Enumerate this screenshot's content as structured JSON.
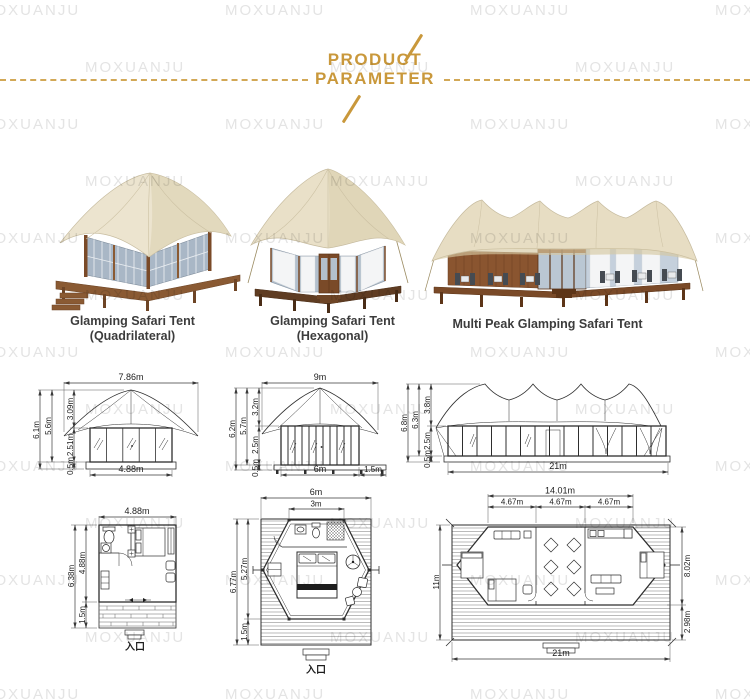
{
  "watermark": {
    "text": "MOXUANJU"
  },
  "header": {
    "title_line1": "PRODUCT",
    "title_line2": "PARAMETER"
  },
  "products": {
    "p1": {
      "line1": "Glamping Safari Tent",
      "line2": "(Quadrilateral)"
    },
    "p2": {
      "line1": "Glamping Safari Tent",
      "line2": "(Hexagonal)"
    },
    "p3": {
      "line1": "Multi Peak Glamping Safari Tent"
    }
  },
  "elevations": {
    "quadrilateral": {
      "top_width": "7.86m",
      "total_height": "6.1m",
      "roof_wall_height": "5.6m",
      "roof_height": "3.09m",
      "wall_height": "2.51m",
      "base_height": "0.5m",
      "bottom_width": "4.88m"
    },
    "hexagonal": {
      "top_width": "9m",
      "total_height": "6.2m",
      "roof_wall_height": "5.7m",
      "roof_height": "3.2m",
      "wall_height": "2.5m",
      "base_height": "0.5m",
      "bottom_width": "6m",
      "deck_extension": "1.5m"
    },
    "multi_peak": {
      "total_height": "6.8m",
      "roof_wall_height": "6.3m",
      "roof_height": "3.8m",
      "wall_height": "2.5m",
      "base_height": "0.5m",
      "bottom_width": "21m"
    }
  },
  "floor_plans": {
    "quadrilateral": {
      "top_width": "4.88m",
      "total_depth": "6.38m",
      "room_depth": "4.88m",
      "deck_depth": "1.5m",
      "entrance": "入口"
    },
    "hexagonal": {
      "top_width": "6m",
      "roof_top_width": "3m",
      "total_depth": "6.77m",
      "room_depth": "5.27m",
      "deck_depth": "1.5m",
      "entrance": "入口"
    },
    "multi_peak": {
      "top_width": "14.01m",
      "seg1": "4.67m",
      "seg2": "4.67m",
      "seg3": "4.67m",
      "left_depth": "11m",
      "room_depth": "8.02m",
      "deck_depth": "2.98m",
      "bottom_width": "21m"
    }
  },
  "colors": {
    "accent": "#C9983B",
    "roof_cream": "#ECE4CF",
    "wood_brown": "#8A5A33",
    "glass_blue": "#AEBDCB",
    "line": "#3A3A3A",
    "watermark_gray": "#E4E4E4"
  }
}
